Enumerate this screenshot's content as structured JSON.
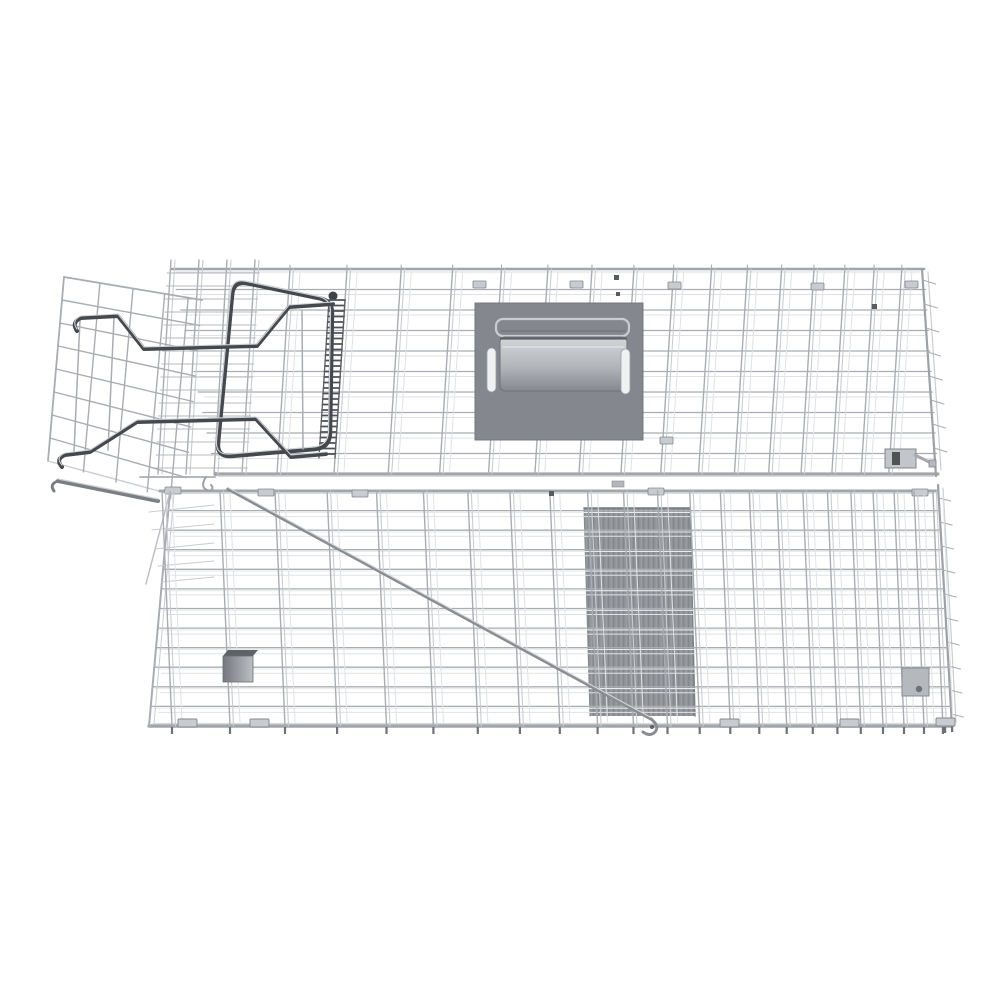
{
  "meta": {
    "type": "product-render",
    "subject": "Humane live animal trap cage made of galvanised steel wire mesh, shown folded flat on a white background with carry handle plate, trip plate pedal, trigger rod and spring-loaded door assembly",
    "background": "#ffffff"
  },
  "parts": {
    "top_panel": "wire mesh top panel",
    "front_panel": "wire mesh front/floor panel",
    "right_end": "right end panel edge",
    "door_assembly": "open spring door panel",
    "door_springs": "door spring lever wires",
    "lever_frame": "door lock lever frame",
    "spring_coil": "coiled door spring",
    "door_guide_band": "door guide channel mesh",
    "handle_plate": "carry handle mounting plate",
    "carry_handle": "folding carry handle",
    "trip_plate": "trip plate pedal seen through mesh",
    "trigger_rod": "diagonal trigger rod with hook",
    "hardware": "wire clips, latch bracket and feet"
  },
  "colors": {
    "background": "#ffffff",
    "wire_mid": "#a9adb2",
    "wire_light": "#c9cdd1",
    "wire_ghost": "#e0e2e5",
    "wire_bright": "#e9ebec",
    "rail": "#a2a6ab",
    "rail_hi": "#d8dbde",
    "dark_steel": "#45494e",
    "dark_steel_hi": "#ced1d5",
    "door_rail": "#7b7f84",
    "plate_fill": "#84888e",
    "plate_edge": "#75797f",
    "grip_light": "#d3d6d9",
    "grip_dark": "#85898f",
    "grip_edge": "#5f6368",
    "slot_white": "#eff1f2",
    "trip_base": "#8f9398",
    "trip_stripe_light": "#9da1a6",
    "trip_stripe_dark": "#83878c",
    "trip_edge": "#74787d",
    "clip_light": "#c8cbcf",
    "clip_stroke": "#83878c",
    "clip_dark": "#585c61",
    "foot": "#6e7277",
    "rod": "#898d92",
    "rod_hi": "#d3d6d9",
    "box_from": "#74787e",
    "box_to": "#bbbec2"
  }
}
